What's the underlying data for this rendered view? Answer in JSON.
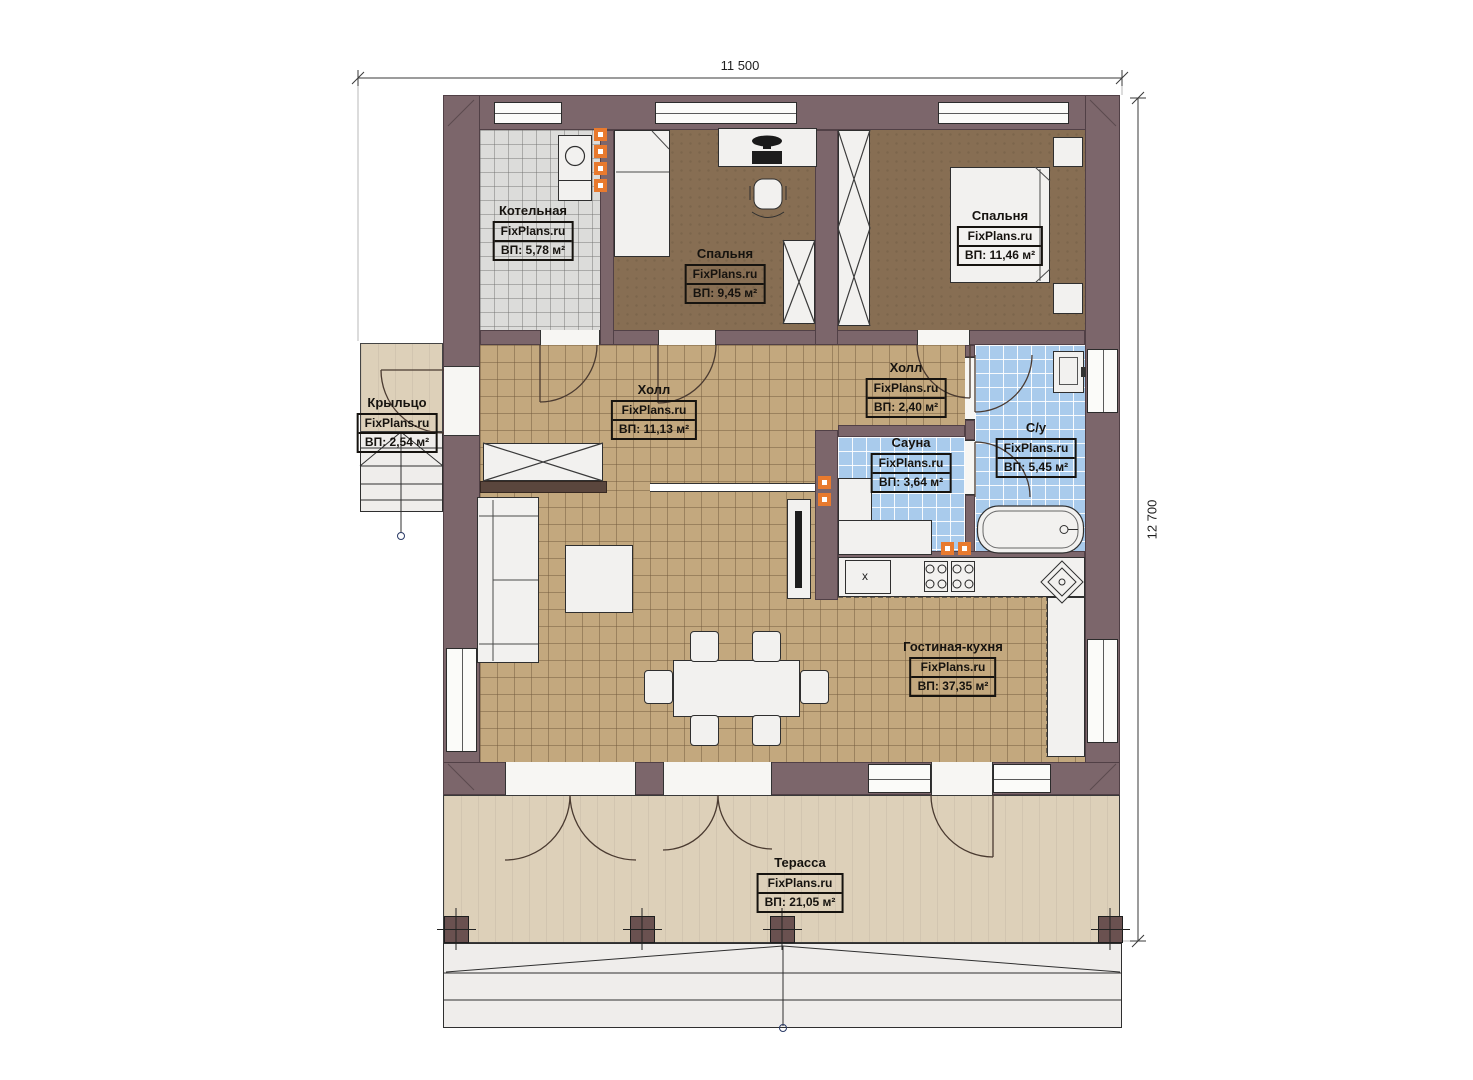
{
  "watermark": "FixPlans.ru",
  "dimensions": {
    "width_label": "11 500",
    "height_label": "12 700"
  },
  "rooms": [
    {
      "name": "Котельная",
      "area": "ВП: 5,78 м²"
    },
    {
      "name": "Спальня",
      "area": "ВП: 9,45 м²"
    },
    {
      "name": "Спальня",
      "area": "ВП: 11,46 м²"
    },
    {
      "name": "Крыльцо",
      "area": "ВП: 2,54 м²"
    },
    {
      "name": "Холл",
      "area": "ВП: 11,13 м²"
    },
    {
      "name": "Холл",
      "area": "ВП: 2,40 м²"
    },
    {
      "name": "Сауна",
      "area": "ВП: 3,64 м²"
    },
    {
      "name": "С/у",
      "area": "ВП: 5,45 м²"
    },
    {
      "name": "Гостиная-кухня",
      "area": "ВП: 37,35 м²"
    },
    {
      "name": "Терасса",
      "area": "ВП: 21,05 м²"
    }
  ],
  "kitchen": {
    "appliance_marker": "х"
  },
  "colors": {
    "wall": "#7c666b",
    "floor_tan": "#c3a87e",
    "floor_brown": "#876e53",
    "floor_blue": "#a9cbec",
    "floor_gray": "#dcdcda",
    "terrace": "#ddd0b9",
    "radiator": "#e87a2e"
  }
}
